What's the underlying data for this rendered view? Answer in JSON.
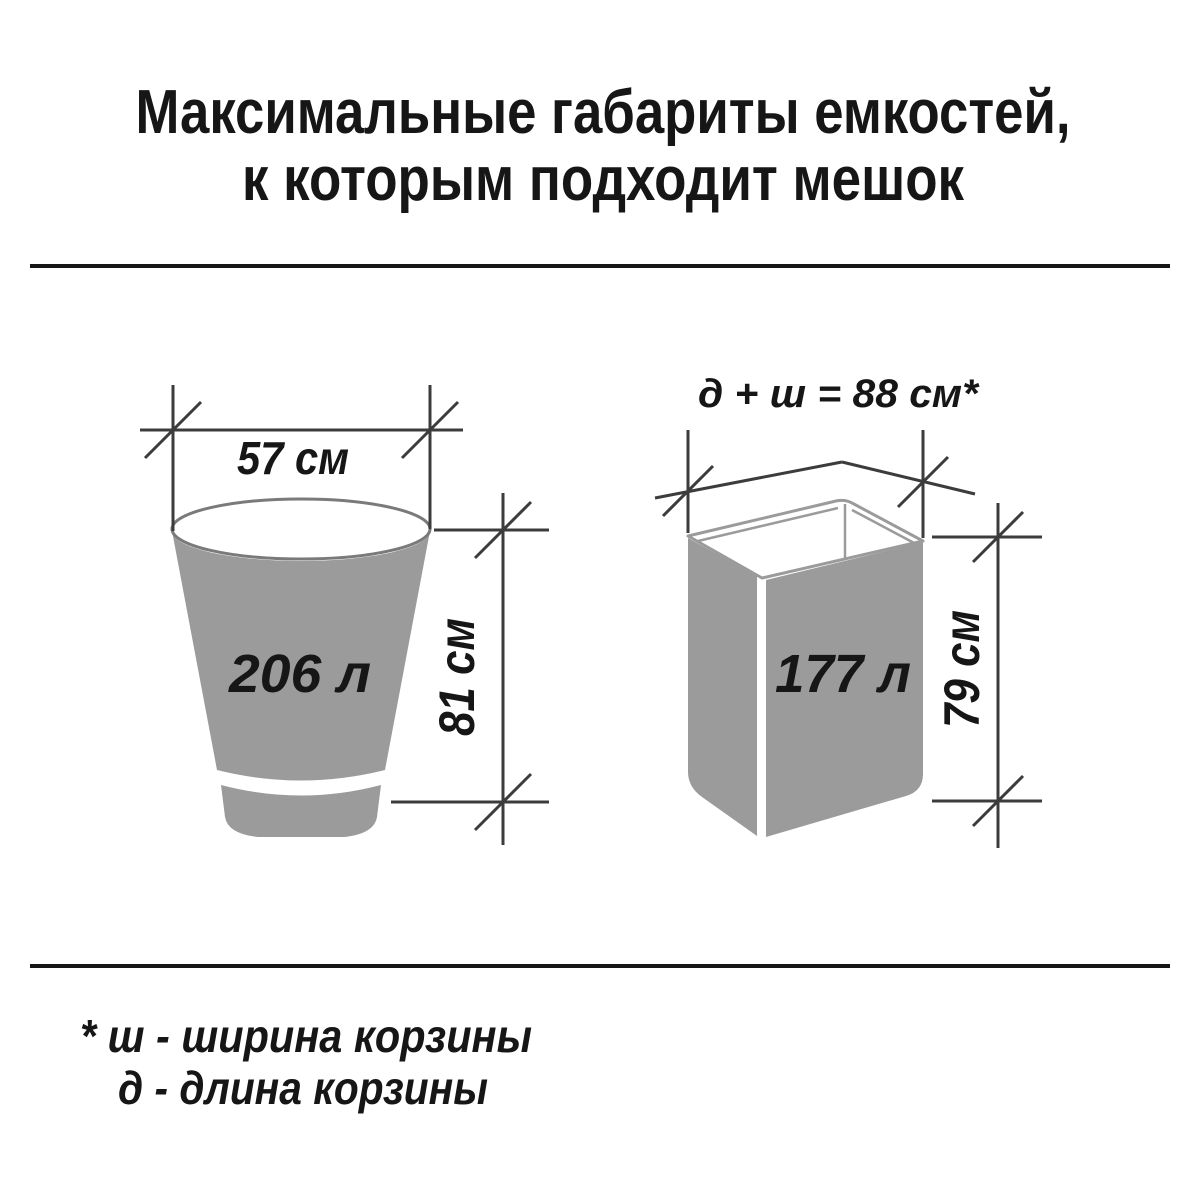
{
  "title": {
    "line1": "Максимальные габариты емкостей,",
    "line2": "к которым подходит мешок"
  },
  "bucket": {
    "width_label": "57 см",
    "volume_label": "206 л",
    "height_label": "81 см"
  },
  "box": {
    "formula_label": "д + ш = 88 см*",
    "volume_label": "177 л",
    "height_label": "79 см"
  },
  "footnote": {
    "line1": "* ш - ширина корзины",
    "line2": "д - длина корзины"
  },
  "colors": {
    "text": "#161616",
    "dimension_line": "#3c3c3c",
    "container_fill": "#9b9b9b",
    "container_outline": "#7a7a7a",
    "divider": "#161616"
  }
}
